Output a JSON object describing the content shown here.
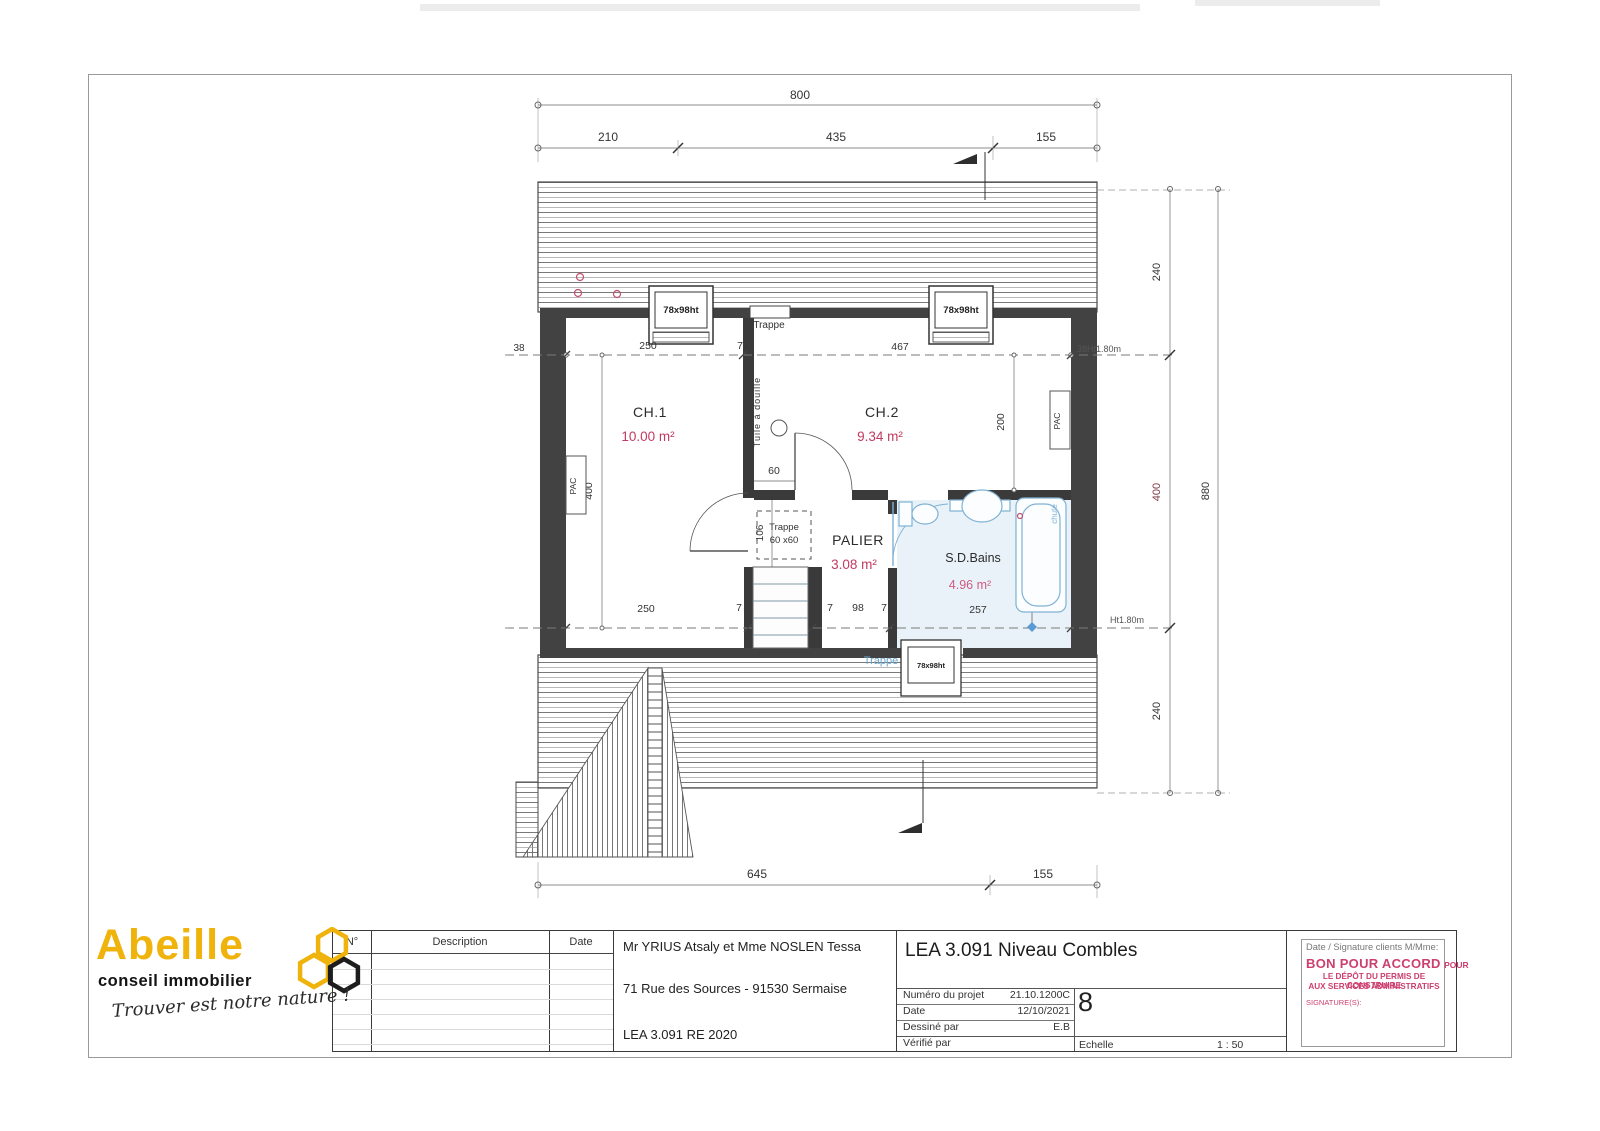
{
  "plan": {
    "dim_top_overall": "800",
    "dim_top_segments": [
      "210",
      "435",
      "155"
    ],
    "dim_bottom_segments": [
      "645",
      "155"
    ],
    "dim_right_segments": [
      "240",
      "400",
      "240"
    ],
    "dim_right_overall": "880",
    "dim_left_wall": "38",
    "mark_right_top": "38Ht1.80m",
    "mark_right_bottom": "Ht1.80m",
    "dim_int_top": [
      "250",
      "7",
      "467"
    ],
    "dim_int_bottom": [
      "250",
      "7",
      "98",
      "7",
      "98",
      "7",
      "257"
    ],
    "dim_ch1_depth": "400",
    "dim_ch2_depth": "200",
    "dim_passage": "60",
    "dim_trappe_h": "106",
    "dim_tub": "193",
    "rooms": [
      {
        "name": "CH.1",
        "area": "10.00 m²"
      },
      {
        "name": "CH.2",
        "area": "9.34 m²"
      },
      {
        "name": "PALIER",
        "area": "3.08 m²"
      },
      {
        "name": "S.D.Bains",
        "area": "4.96 m²"
      }
    ],
    "labels": {
      "trappe": "Trappe",
      "trappe_size": "60 x60",
      "window": "78x98ht",
      "tuile": "Tuile à douille",
      "chute": "chute",
      "pac": "PAC"
    }
  },
  "title_block": {
    "revisions": {
      "headers": [
        "N°",
        "Description",
        "Date"
      ]
    },
    "client": {
      "line1": "Mr YRIUS Atsaly et Mme NOSLEN Tessa",
      "line2": "71 Rue des Sources - 91530 Sermaise",
      "line3": "LEA 3.091 RE 2020"
    },
    "project": {
      "title": "LEA 3.091 Niveau Combles",
      "fields": [
        {
          "label": "Numéro du projet",
          "value": "21.10.1200C"
        },
        {
          "label": "Date",
          "value": "12/10/2021"
        },
        {
          "label": "Dessiné par",
          "value": "E.B"
        },
        {
          "label": "Vérifié par",
          "value": ""
        }
      ],
      "sheet_number": "8",
      "scale_label": "Echelle",
      "scale_value": "1 : 50"
    },
    "signature": {
      "header": "Date / Signature clients M/Mme:",
      "approval_main": "BON POUR ACCORD",
      "approval_suffix": "POUR",
      "approval_line2": "LE DÉPÔT DU PERMIS DE CONSTRUIRE",
      "approval_line3": "AUX SERVICES ADMINISTRATIFS",
      "signature_label": "SIGNATURE(S):"
    }
  },
  "logo": {
    "brand": "Abeille",
    "subtitle": "conseil immobilier",
    "tagline": "Trouver est notre nature !"
  }
}
